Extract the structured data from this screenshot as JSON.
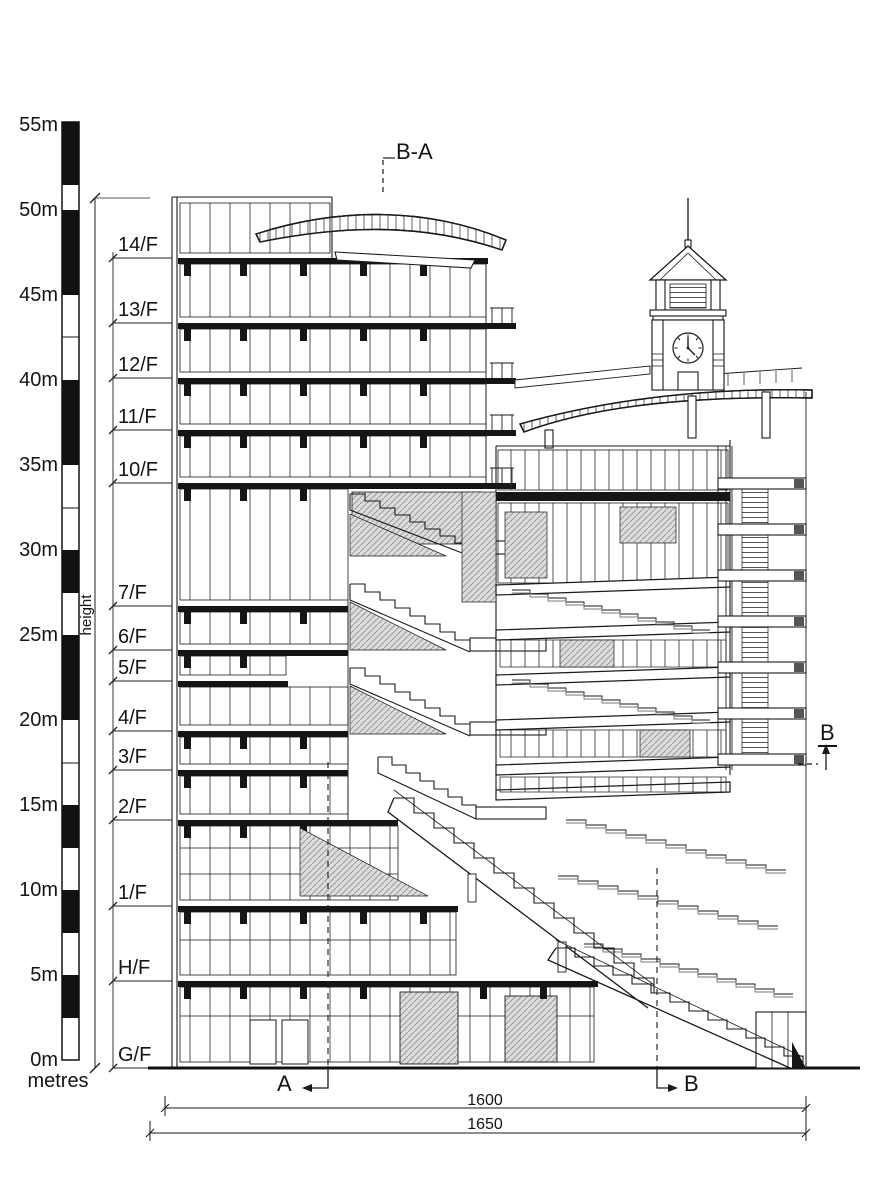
{
  "drawing_type": "building-section-elevation",
  "colors": {
    "ink": "#1a1a1a",
    "hatch": "#8a8a8a",
    "panel": "#d6d6d6",
    "background": "#ffffff"
  },
  "scale_bar": {
    "unit_label": "metres",
    "axis_label": "height",
    "tick_labels": [
      "55m",
      "50m",
      "45m",
      "40m",
      "35m",
      "30m",
      "25m",
      "20m",
      "15m",
      "10m",
      "5m",
      "0m"
    ]
  },
  "floor_labels": [
    "14/F",
    "13/F",
    "12/F",
    "11/F",
    "10/F",
    "7/F",
    "6/F",
    "5/F",
    "4/F",
    "3/F",
    "2/F",
    "1/F",
    "H/F",
    "G/F"
  ],
  "section_markers": {
    "top": "B-A",
    "bottom_left": "A",
    "bottom_right": "B",
    "right": "B"
  },
  "dimensions": {
    "upper": "1600",
    "lower": "1650"
  }
}
